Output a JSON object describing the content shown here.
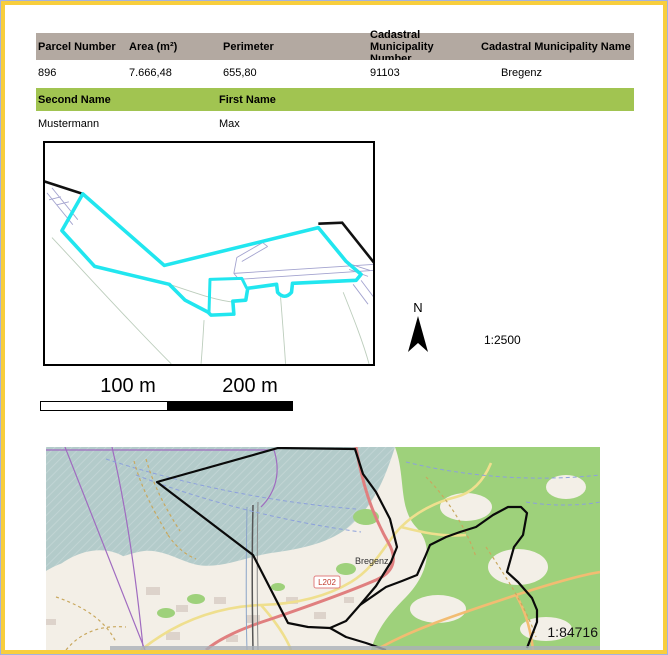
{
  "page": {
    "background": "#ffffff",
    "frame_outer_blue": "#a4b2e0",
    "frame_yellow": "#f8ce3d"
  },
  "parcel_table": {
    "header_bg": "#b3a9a1",
    "headers": [
      "Parcel Number",
      "Area (m²)",
      "Perimeter",
      "Cadastral Municipality Number",
      "Cadastral Municipality Name"
    ],
    "row": {
      "parcel_number": "896",
      "area": "7.666,48",
      "perimeter": "655,80",
      "municipality_number": "91103",
      "municipality_name": "Bregenz"
    }
  },
  "owner_table": {
    "header_bg": "#a1c451",
    "headers": [
      "Second Name",
      "First Name"
    ],
    "row": {
      "second_name": "Mustermann",
      "first_name": "Max"
    }
  },
  "detail_map": {
    "parcel_outline_color": "#21e6ef",
    "boundary_color": "#000000",
    "north_label": "N",
    "scale_text": "1:2500"
  },
  "scalebar": {
    "labels": [
      "100 m",
      "200 m"
    ]
  },
  "overview_map": {
    "city_label": "Bregenz",
    "road_label": "L202",
    "scale_text": "1:84716",
    "lake_color": "#b3cbca",
    "forest_color": "#9ed17b",
    "boundary_color": "#0a0a0a"
  }
}
